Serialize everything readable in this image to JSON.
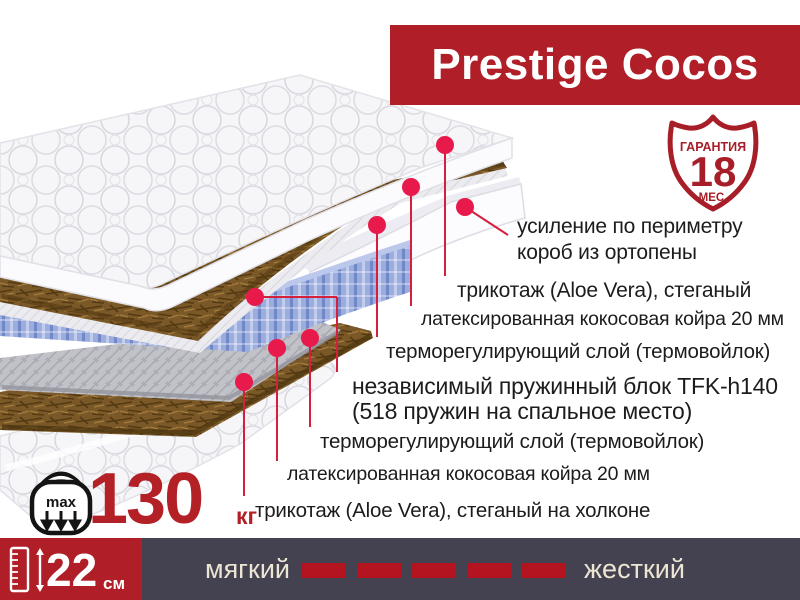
{
  "banner": {
    "title": "Prestige Cocos"
  },
  "badge": {
    "top": "ГАРАНТИЯ",
    "number": "18",
    "bottom": "МЕС."
  },
  "layer_labels": [
    {
      "text": "усиление по периметру\nкороб из ортопены"
    },
    {
      "text": "трикотаж (Aloe Vera), стеганый"
    },
    {
      "text": "латексированная кокосовая койра 20 мм"
    },
    {
      "text": "терморегулирующий слой (термовойлок)"
    },
    {
      "text": "независимый пружинный блок TFK-h140\n(518 пружин на спальное место)"
    },
    {
      "text": "терморегулирующий слой (термовойлок)"
    },
    {
      "text": "латексированная кокосовая койра 20 мм"
    },
    {
      "text": "трикотаж (Aloe Vera), стеганый на холконе"
    }
  ],
  "weight": {
    "max_label": "max",
    "value": "130",
    "unit": "кг"
  },
  "height_block": {
    "value": "22",
    "unit": "см"
  },
  "firmness": {
    "soft": "мягкий",
    "hard": "жесткий",
    "dash_count": 5
  },
  "colors": {
    "banner_red": "#b01f27",
    "badge_red": "#a81e28",
    "dot_red": "#e8194b",
    "line_red": "#d41f3e",
    "bar_dark": "#444250",
    "dash_red": "#b3141f",
    "value_red": "#b32127"
  }
}
